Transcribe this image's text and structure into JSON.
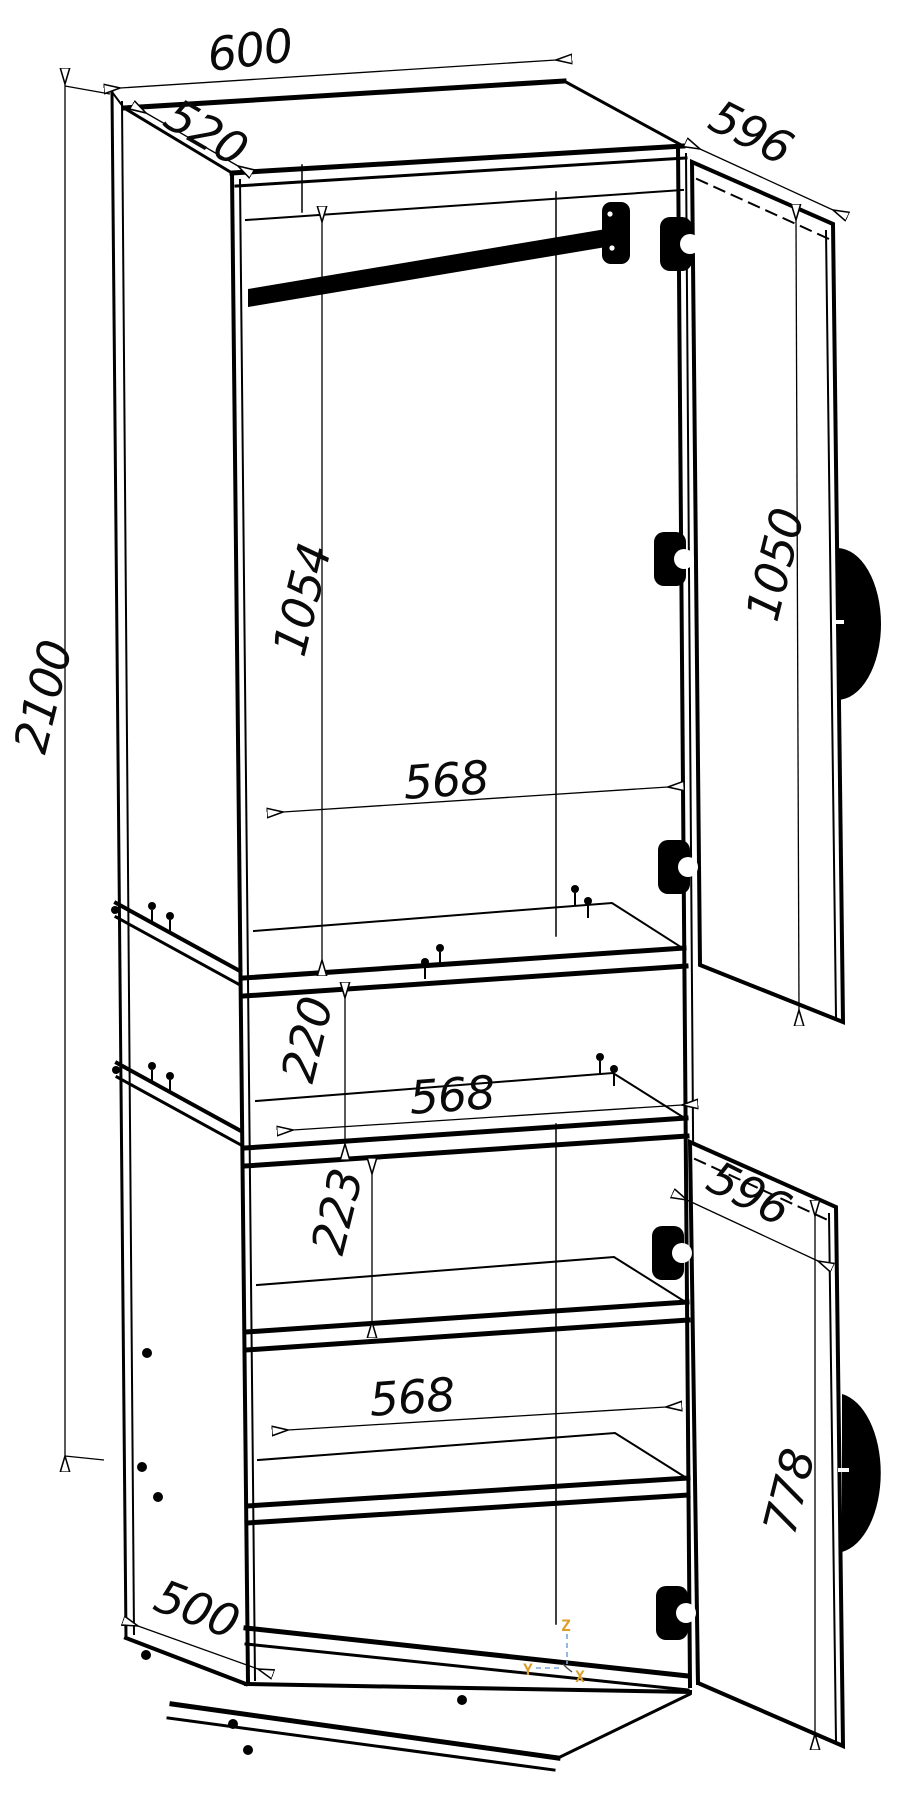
{
  "drawing": {
    "kind": "wardrobe cabinet isometric assembly drawing",
    "background": "#ffffff",
    "line_color": "#000000",
    "dims": {
      "top_width": "600",
      "top_depth": "520",
      "upper_door_width": "596",
      "upper_door_height": "1050",
      "total_height": "2100",
      "hanging_space_height": "1054",
      "interior_width_upper": "568",
      "niche_height": "220",
      "interior_width_middle": "568",
      "shelf_gap": "223",
      "lower_door_width": "596",
      "interior_width_lower": "568",
      "lower_door_height": "778",
      "base_depth": "500"
    },
    "axis": {
      "x": "X",
      "y": "Y",
      "z": "Z",
      "line_color": "#7aa7d8",
      "label_color": "#dd9f2a"
    }
  }
}
